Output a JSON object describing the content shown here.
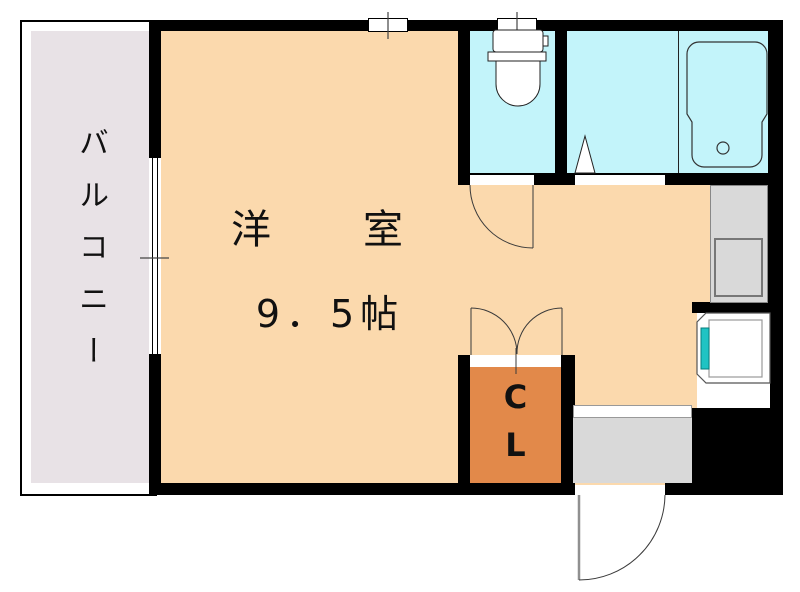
{
  "floorplan": {
    "balcony": {
      "label": "バルコニー"
    },
    "main_room": {
      "name": "洋　室",
      "size": "9．5帖"
    },
    "closet": {
      "line1": "C",
      "line2": "L"
    },
    "colors": {
      "wall": "#000000",
      "room_floor": "#fbd9ad",
      "wet_floor": "#c3f4fa",
      "balcony_floor": "#e8e2e6",
      "closet_floor": "#e2894a",
      "entrance_floor": "#d9d9d9",
      "counter": "#d9d9d9",
      "sink": "#1fc3c3"
    }
  }
}
